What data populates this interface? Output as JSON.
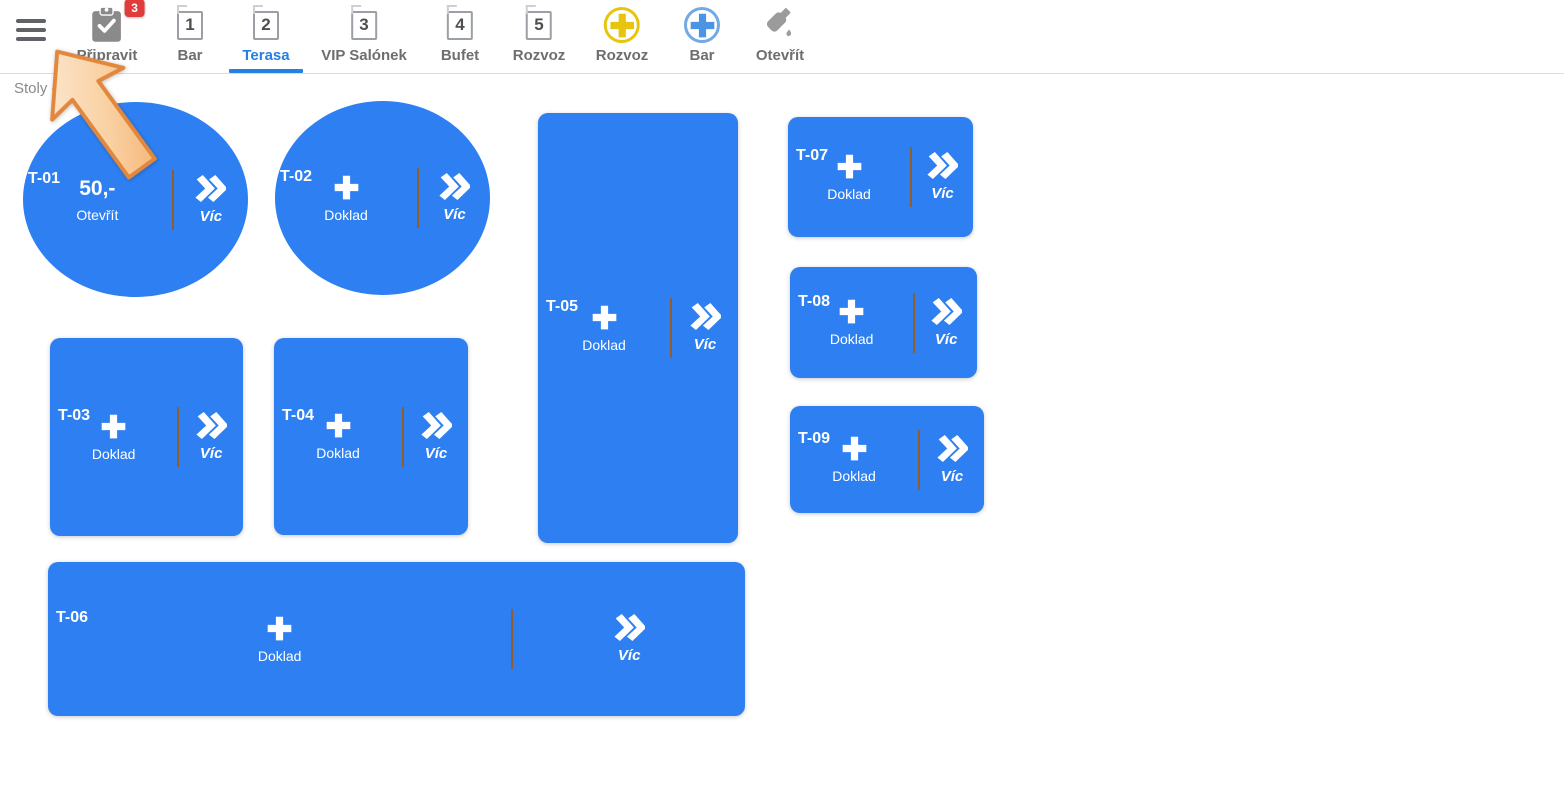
{
  "toolbar": {
    "items": [
      {
        "label": "Připravit",
        "icon": "clipboard-check-icon",
        "badge": "3"
      },
      {
        "label": "Bar",
        "icon": "numbered-square-icon",
        "number": "1"
      },
      {
        "label": "Terasa",
        "icon": "numbered-square-icon",
        "number": "2",
        "active": true
      },
      {
        "label": "VIP Salónek",
        "icon": "numbered-square-icon",
        "number": "3"
      },
      {
        "label": "Bufet",
        "icon": "numbered-square-icon",
        "number": "4"
      },
      {
        "label": "Rozvoz",
        "icon": "numbered-square-icon",
        "number": "5"
      },
      {
        "label": "Rozvoz",
        "icon": "plus-circle-icon",
        "accent": "#e7c50f"
      },
      {
        "label": "Bar",
        "icon": "plus-circle-icon",
        "accent": "#4a94e2"
      },
      {
        "label": "Otevřít",
        "icon": "bottle-open-icon"
      }
    ]
  },
  "page": {
    "breadcrumb": "Stoly - Terasa"
  },
  "tables": [
    {
      "label": "T-01",
      "shape": "ellipse",
      "amount": "50,-",
      "action": "Otevřít",
      "more_label": "Víc"
    },
    {
      "label": "T-02",
      "shape": "ellipse",
      "add_label": "Doklad",
      "more_label": "Víc"
    },
    {
      "label": "T-03",
      "shape": "rect",
      "add_label": "Doklad",
      "more_label": "Víc"
    },
    {
      "label": "T-04",
      "shape": "rect",
      "add_label": "Doklad",
      "more_label": "Víc"
    },
    {
      "label": "T-05",
      "shape": "rect",
      "add_label": "Doklad",
      "more_label": "Víc"
    },
    {
      "label": "T-06",
      "shape": "rect",
      "add_label": "Doklad",
      "more_label": "Víc"
    },
    {
      "label": "T-07",
      "shape": "rect",
      "add_label": "Doklad",
      "more_label": "Víc"
    },
    {
      "label": "T-08",
      "shape": "rect",
      "add_label": "Doklad",
      "more_label": "Víc"
    },
    {
      "label": "T-09",
      "shape": "rect",
      "add_label": "Doklad",
      "more_label": "Víc"
    }
  ],
  "colors": {
    "tile_blue": "#2e80f2",
    "active_tab_blue": "#2580e4",
    "badge_red": "#e23b3b",
    "divider_brown": "#8f5e2b",
    "accent_yellow": "#e7c50f",
    "accent_light_blue": "#72a9e6",
    "arrow_fill": "#f9cf9f",
    "arrow_border": "#e2873b"
  }
}
